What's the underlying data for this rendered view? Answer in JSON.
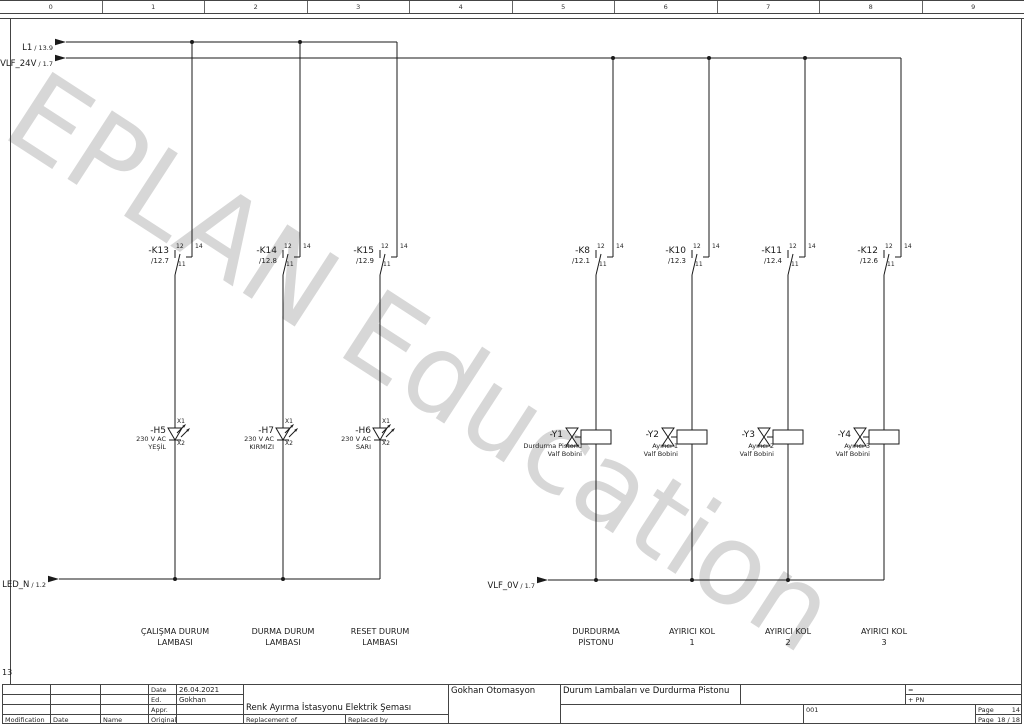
{
  "watermark": "EPLAN Education",
  "ruler": [
    "0",
    "1",
    "2",
    "3",
    "4",
    "5",
    "6",
    "7",
    "8",
    "9"
  ],
  "nav_number": "13",
  "colors": {
    "line": "#1a1a1a",
    "watermark": "#d7d7d7",
    "background": "#ffffff"
  },
  "rails": {
    "l1": {
      "name": "L1",
      "ref": "/ 13.9"
    },
    "vlf24": {
      "name": "VLF_24V",
      "ref": "/ 1.7"
    },
    "ledn": {
      "name": "LED_N",
      "ref": "/ 1.2"
    },
    "vlf0": {
      "name": "VLF_0V",
      "ref": "/ 1.7"
    }
  },
  "terminals": {
    "nc": "12",
    "no": "14",
    "com": "11",
    "x1": "X1",
    "x2": "X2"
  },
  "contacts": [
    {
      "name": "-K13",
      "ref": "/12.7"
    },
    {
      "name": "-K14",
      "ref": "/12.8"
    },
    {
      "name": "-K15",
      "ref": "/12.9"
    },
    {
      "name": "-K8",
      "ref": "/12.1"
    },
    {
      "name": "-K10",
      "ref": "/12.3"
    },
    {
      "name": "-K11",
      "ref": "/12.4"
    },
    {
      "name": "-K12",
      "ref": "/12.6"
    }
  ],
  "lamps": [
    {
      "name": "-H5",
      "voltage": "230 V AC",
      "color": "YEŞİL"
    },
    {
      "name": "-H7",
      "voltage": "230 V AC",
      "color": "KIRMIZI"
    },
    {
      "name": "-H6",
      "voltage": "230 V AC",
      "color": "SARI"
    }
  ],
  "valves": [
    {
      "name": "-Y1",
      "line1": "Durdurma Pistonu",
      "line2": "Valf Bobini"
    },
    {
      "name": "-Y2",
      "line1": "Ayırıcı 1",
      "line2": "Valf Bobini"
    },
    {
      "name": "-Y3",
      "line1": "Ayırıcı 2",
      "line2": "Valf Bobini"
    },
    {
      "name": "-Y4",
      "line1": "Ayırıcı 3",
      "line2": "Valf Bobini"
    }
  ],
  "function_labels": [
    {
      "line1": "ÇALIŞMA DURUM",
      "line2": "LAMBASI"
    },
    {
      "line1": "DURMA DURUM",
      "line2": "LAMBASI"
    },
    {
      "line1": "RESET DURUM",
      "line2": "LAMBASI"
    },
    {
      "line1": "DURDURMA",
      "line2": "PİSTONU"
    },
    {
      "line1": "AYIRICI KOL",
      "line2": "1"
    },
    {
      "line1": "AYIRICI KOL",
      "line2": "2"
    },
    {
      "line1": "AYIRICI KOL",
      "line2": "3"
    }
  ],
  "titleblock": {
    "modification": "Modification",
    "date_col": "Date",
    "name_col": "Name",
    "date_label": "Date",
    "date_value": "26.04.2021",
    "ed_label": "Ed.",
    "ed_value": "Gokhan",
    "appr_label": "Appr.",
    "original_label": "Original",
    "replacement_of": "Replacement of",
    "replaced_by": "Replaced by",
    "project_title": "Renk Ayırma İstasyonu Elektrik Şeması",
    "company": "Gokhan Otomasyon",
    "drawing_title": "Durum Lambaları ve Durdurma Pistonu",
    "structure_eq": "=",
    "structure_plus": "+ PN",
    "sheet_no": "001",
    "page_label": "Page",
    "page_value": "14",
    "page_label2": "Page",
    "page_total": "18 / 18"
  }
}
